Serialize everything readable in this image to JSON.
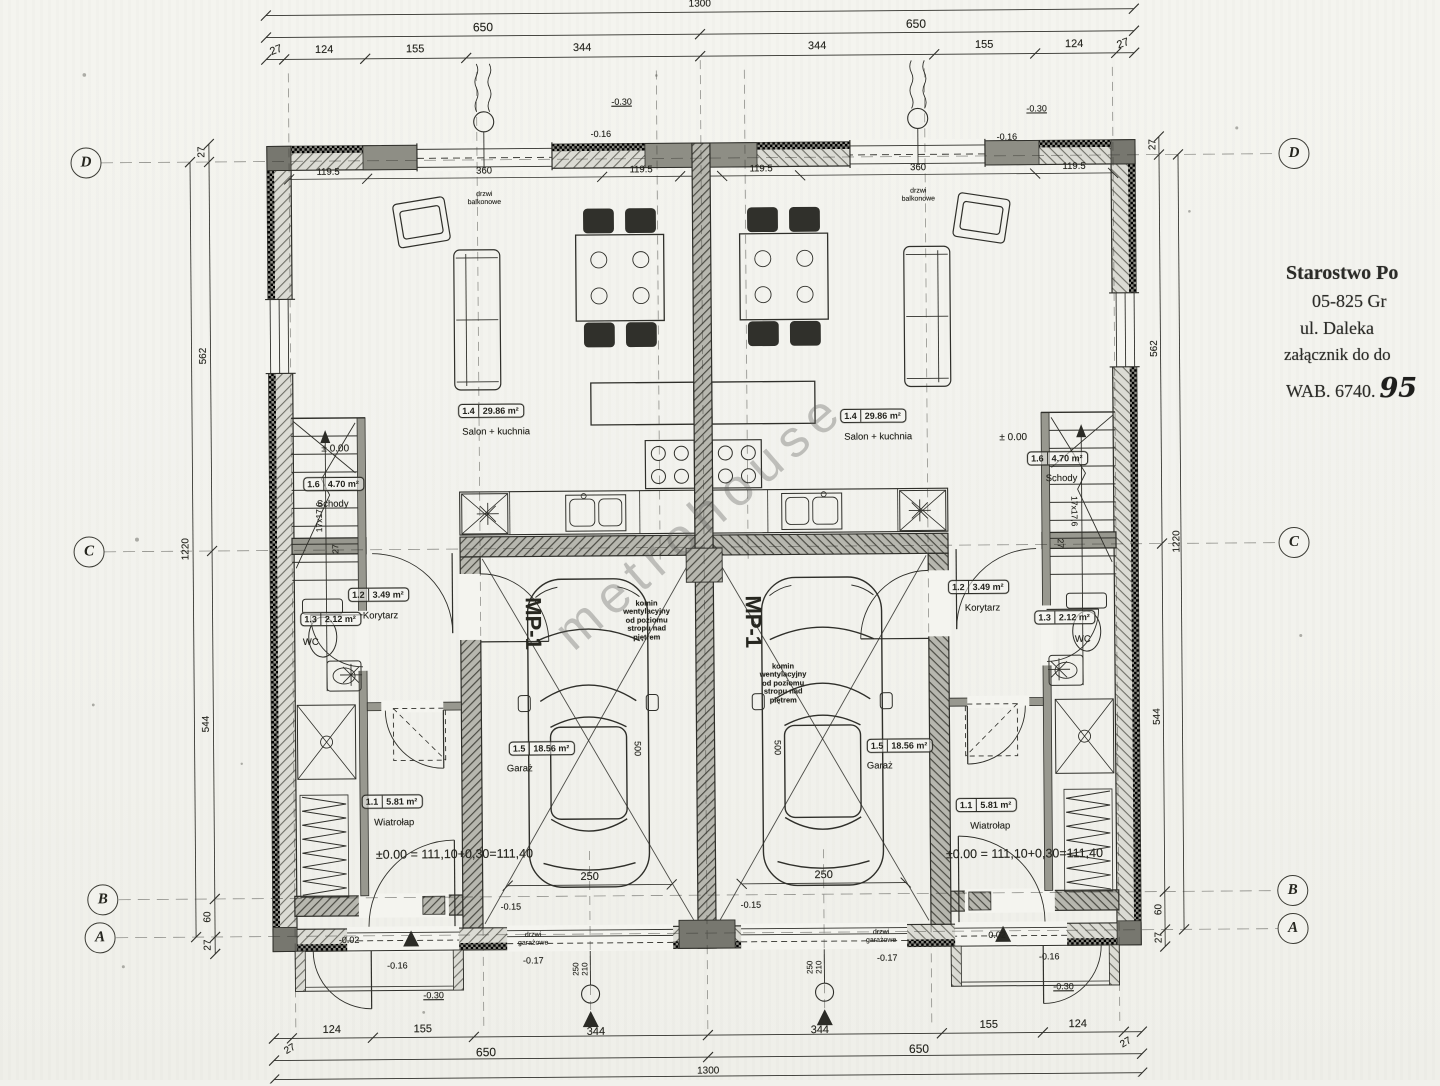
{
  "watermark": "metrohouse",
  "stamp": {
    "line1": "Starostwo Po",
    "line2": "05-825 Gr",
    "line3": "ul. Daleka",
    "line4": "załącznik do do",
    "wab": "WAB. 6740.",
    "wab_hand": "95"
  },
  "grid_axes": [
    {
      "label": "D",
      "lx": 89,
      "rx": 1297,
      "y": 158
    },
    {
      "label": "C",
      "lx": 89,
      "rx": 1294,
      "y": 547
    },
    {
      "label": "B",
      "lx": 100,
      "rx": 1290,
      "y": 895
    },
    {
      "label": "A",
      "lx": 97,
      "rx": 1290,
      "y": 933
    }
  ],
  "rooms": [
    {
      "id": "salon-left",
      "num": "1.4",
      "area": "29.86 m²",
      "name": "Salon + kuchnia",
      "bx": 492,
      "by": 409,
      "nx": 497,
      "ny": 431
    },
    {
      "id": "schody-left",
      "num": "1.6",
      "area": "4.70 m²",
      "name": "Schody",
      "bx": 334,
      "by": 481,
      "nx": 333,
      "ny": 502
    },
    {
      "id": "korytarz-left",
      "num": "1.2",
      "area": "3.49 m²",
      "name": "Korytarz",
      "bx": 378,
      "by": 592,
      "nx": 380,
      "ny": 614
    },
    {
      "id": "wc-left",
      "num": "1.3",
      "area": "2.12 m²",
      "name": "WC",
      "bx": 330,
      "by": 616,
      "nx": 310,
      "ny": 640
    },
    {
      "id": "wiatrolap-left",
      "num": "1.1",
      "area": "5.81 m²",
      "name": "Wiatrołap",
      "bx": 390,
      "by": 799,
      "nx": 392,
      "ny": 821
    },
    {
      "id": "garaz-left",
      "num": "1.5",
      "area": "18.56 m²",
      "name": "Garaż",
      "bx": 540,
      "by": 747,
      "nx": 518,
      "ny": 768
    },
    {
      "id": "salon-right",
      "num": "1.4",
      "area": "29.86 m²",
      "name": "Salon + kuchnia",
      "bx": 874,
      "by": 417,
      "nx": 879,
      "ny": 439
    },
    {
      "id": "schody-right",
      "num": "1.6",
      "area": "4.70 m²",
      "name": "Schody",
      "bx": 1058,
      "by": 461,
      "nx": 1062,
      "ny": 482
    },
    {
      "id": "korytarz-right",
      "num": "1.2",
      "area": "3.49 m²",
      "name": "Korytarz",
      "bx": 978,
      "by": 589,
      "nx": 982,
      "ny": 611
    },
    {
      "id": "wc-right",
      "num": "1.3",
      "area": "2.12 m²",
      "name": "WC",
      "bx": 1064,
      "by": 620,
      "nx": 1082,
      "ny": 643
    },
    {
      "id": "wiatrolap-right",
      "num": "1.1",
      "area": "5.81 m²",
      "name": "Wiatrołap",
      "bx": 984,
      "by": 807,
      "nx": 988,
      "ny": 829
    },
    {
      "id": "garaz-right",
      "num": "1.5",
      "area": "18.56 m²",
      "name": "Garaż",
      "bx": 898,
      "by": 747,
      "nx": 878,
      "ny": 768
    }
  ],
  "labels": [
    {
      "t": "1300",
      "x": 704,
      "y": 4,
      "s": 10
    },
    {
      "t": "650",
      "x": 487,
      "y": 26,
      "s": 12
    },
    {
      "t": "650",
      "x": 920,
      "y": 26,
      "s": 12
    },
    {
      "t": "27",
      "x": 280,
      "y": 47,
      "s": 11,
      "r": -20
    },
    {
      "t": "124",
      "x": 328,
      "y": 47,
      "s": 11
    },
    {
      "t": "155",
      "x": 419,
      "y": 47,
      "s": 11
    },
    {
      "t": "344",
      "x": 586,
      "y": 47,
      "s": 11
    },
    {
      "t": "344",
      "x": 821,
      "y": 47,
      "s": 11
    },
    {
      "t": "155",
      "x": 988,
      "y": 47,
      "s": 11
    },
    {
      "t": "124",
      "x": 1078,
      "y": 47,
      "s": 11
    },
    {
      "t": "27",
      "x": 1127,
      "y": 47,
      "s": 11,
      "r": -20
    },
    {
      "t": "119.5",
      "x": 331,
      "y": 170,
      "s": 9.5
    },
    {
      "t": "360",
      "x": 487,
      "y": 170,
      "s": 9.5
    },
    {
      "t": "119.5",
      "x": 644,
      "y": 170,
      "s": 9.5
    },
    {
      "t": "119.5",
      "x": 764,
      "y": 170,
      "s": 9.5
    },
    {
      "t": "360",
      "x": 921,
      "y": 170,
      "s": 9.5
    },
    {
      "t": "119.5",
      "x": 1077,
      "y": 170,
      "s": 9.5
    },
    {
      "t": "drzwi\nbalkonowe",
      "x": 487,
      "y": 197,
      "s": 7,
      "n": "balcony-door-note"
    },
    {
      "t": "drzwi\nbalkonowe",
      "x": 921,
      "y": 197,
      "s": 7,
      "n": "balcony-door-note"
    },
    {
      "t": "-0.16",
      "x": 604,
      "y": 133,
      "s": 9
    },
    {
      "t": "-0.16",
      "x": 1010,
      "y": 139,
      "s": 9
    },
    {
      "t": "-0.30",
      "x": 625,
      "y": 101,
      "s": 9,
      "u": 1
    },
    {
      "t": "-0.30",
      "x": 1040,
      "y": 111,
      "s": 9,
      "u": 1
    },
    {
      "t": "27",
      "x": 205,
      "y": 148,
      "s": 10,
      "r": -90
    },
    {
      "t": "562",
      "x": 205,
      "y": 352,
      "s": 10,
      "r": -90
    },
    {
      "t": "544",
      "x": 205,
      "y": 720,
      "s": 10,
      "r": -90
    },
    {
      "t": "60",
      "x": 205,
      "y": 913,
      "s": 10,
      "r": -90
    },
    {
      "t": "27",
      "x": 205,
      "y": 941,
      "s": 10,
      "r": -90
    },
    {
      "t": "1220",
      "x": 186,
      "y": 545,
      "s": 10,
      "r": -90
    },
    {
      "t": "27",
      "x": 1156,
      "y": 148,
      "s": 10,
      "r": -90
    },
    {
      "t": "562",
      "x": 1156,
      "y": 352,
      "s": 10,
      "r": -90
    },
    {
      "t": "544",
      "x": 1156,
      "y": 720,
      "s": 10,
      "r": -90
    },
    {
      "t": "60",
      "x": 1156,
      "y": 913,
      "s": 10,
      "r": -90
    },
    {
      "t": "27",
      "x": 1156,
      "y": 941,
      "s": 10,
      "r": -90
    },
    {
      "t": "1220",
      "x": 1177,
      "y": 545,
      "s": 10,
      "r": -90
    },
    {
      "t": "± 0.00",
      "x": 336,
      "y": 446,
      "s": 10,
      "n": "level-mark"
    },
    {
      "t": "± 0.00",
      "x": 1014,
      "y": 440,
      "s": 10,
      "n": "level-mark"
    },
    {
      "t": "17x17,6",
      "x": 320,
      "y": 514,
      "s": 8.5,
      "r": -90,
      "n": "stair-riser-note"
    },
    {
      "t": "27",
      "x": 336,
      "y": 546,
      "s": 8.5,
      "r": -90,
      "n": "stair-riser-note"
    },
    {
      "t": "17x17,6",
      "x": 1074,
      "y": 514,
      "s": 8.5,
      "r": 90,
      "n": "stair-riser-note"
    },
    {
      "t": "27",
      "x": 1060,
      "y": 546,
      "s": 8.5,
      "r": 90,
      "n": "stair-riser-note"
    },
    {
      "t": "MP-1",
      "x": 532,
      "y": 622,
      "s": 22,
      "r": 90,
      "w": 600,
      "n": "parking-spot-mark"
    },
    {
      "t": "MP-1",
      "x": 752,
      "y": 622,
      "s": 22,
      "r": 90,
      "w": 600,
      "n": "parking-spot-mark"
    },
    {
      "t": "komin\nwentylacyjny\nod poziomu\nstropu nad\npiętrem",
      "x": 646,
      "y": 620,
      "s": 7.5,
      "w": 700,
      "n": "chimney-note"
    },
    {
      "t": "komin\nwentylacyjny\nod poziomu\nstropu nad\npiętrem",
      "x": 782,
      "y": 684,
      "s": 7.5,
      "w": 700,
      "n": "chimney-note"
    },
    {
      "t": "500",
      "x": 636,
      "y": 748,
      "s": 9,
      "r": 90
    },
    {
      "t": "500",
      "x": 776,
      "y": 748,
      "s": 9,
      "r": 90
    },
    {
      "t": "250",
      "x": 587,
      "y": 876,
      "s": 11
    },
    {
      "t": "250",
      "x": 821,
      "y": 876,
      "s": 11
    },
    {
      "t": "±0.00 = 111,10+0,30=111,40",
      "x": 452,
      "y": 852,
      "s": 12.5,
      "n": "elevation-note"
    },
    {
      "t": "±0.00 = 111,10+0,30=111,40",
      "x": 1022,
      "y": 856,
      "s": 12.5,
      "n": "elevation-note"
    },
    {
      "t": "-0.15",
      "x": 508,
      "y": 905,
      "s": 9
    },
    {
      "t": "-0.15",
      "x": 748,
      "y": 905,
      "s": 9
    },
    {
      "t": "drzwi\ngarażowe",
      "x": 530,
      "y": 938,
      "s": 7,
      "n": "garage-door-note"
    },
    {
      "t": "drzwi\ngarażowe",
      "x": 878,
      "y": 938,
      "s": 7,
      "n": "garage-door-note"
    },
    {
      "t": "-0.17",
      "x": 530,
      "y": 959,
      "s": 9
    },
    {
      "t": "-0.17",
      "x": 884,
      "y": 959,
      "s": 9
    },
    {
      "t": "250\n210",
      "x": 578,
      "y": 968,
      "s": 8,
      "r": -90,
      "n": "door-size-note"
    },
    {
      "t": "250\n210",
      "x": 812,
      "y": 968,
      "s": 8,
      "r": -90,
      "n": "door-size-note"
    },
    {
      "t": "-0.02",
      "x": 346,
      "y": 937,
      "s": 9
    },
    {
      "t": "0.02",
      "x": 994,
      "y": 937,
      "s": 9
    },
    {
      "t": "-0.16",
      "x": 394,
      "y": 963,
      "s": 9
    },
    {
      "t": "-0.16",
      "x": 1046,
      "y": 959,
      "s": 9
    },
    {
      "t": "-0.30",
      "x": 430,
      "y": 993,
      "s": 9,
      "u": 1
    },
    {
      "t": "-0.30",
      "x": 1060,
      "y": 989,
      "s": 9,
      "u": 1
    },
    {
      "t": "124",
      "x": 328,
      "y": 1027,
      "s": 11
    },
    {
      "t": "155",
      "x": 419,
      "y": 1027,
      "s": 11
    },
    {
      "t": "344",
      "x": 592,
      "y": 1031,
      "s": 11
    },
    {
      "t": "344",
      "x": 816,
      "y": 1031,
      "s": 11
    },
    {
      "t": "155",
      "x": 985,
      "y": 1027,
      "s": 11
    },
    {
      "t": "124",
      "x": 1074,
      "y": 1027,
      "s": 11
    },
    {
      "t": "27",
      "x": 286,
      "y": 1046,
      "s": 10,
      "r": -30
    },
    {
      "t": "27",
      "x": 1122,
      "y": 1046,
      "s": 10,
      "r": -30
    },
    {
      "t": "650",
      "x": 482,
      "y": 1051,
      "s": 12
    },
    {
      "t": "650",
      "x": 915,
      "y": 1051,
      "s": 12
    },
    {
      "t": "1300",
      "x": 704,
      "y": 1071,
      "s": 10
    }
  ]
}
